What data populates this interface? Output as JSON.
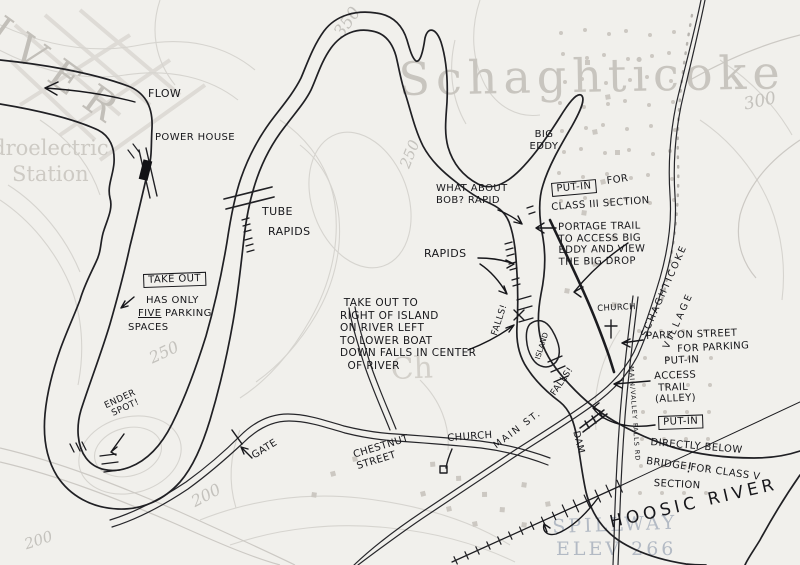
{
  "base_map": {
    "river_name": "RIVER",
    "town_name": "Schaghticoke",
    "hydro_line1": "Hydroelectric",
    "hydro_line2": "Station",
    "church_abbrev": "Ch",
    "spillway_line1": "SPILLWAY",
    "spillway_line2": "ELEV 266",
    "contour_350": "350",
    "contour_300": "300",
    "contour_250_top": "250",
    "contour_250_left": "250",
    "contour_200_bottom": "200",
    "contour_200_corner": "200"
  },
  "annotations": {
    "flow": "FLOW",
    "power_house": "POWER HOUSE",
    "take_out_box": "TAKE OUT",
    "take_out_line1": "HAS ONLY",
    "take_out_five": "FIVE",
    "take_out_parking": " PARKING",
    "take_out_line3": "SPACES",
    "tube": "TUBE",
    "tube_rapids": "RAPIDS",
    "big_eddy": "BIG\nEDDY",
    "bob_rapid": "WHAT ABOUT\nBOB? RAPID",
    "rapids": "RAPIDS",
    "putin_class3_box": "PUT-IN",
    "putin_class3_for": "FOR",
    "putin_class3_class": "CLASS III SECTION",
    "portage_note": "PORTAGE TRAIL\nTO ACCESS BIG\nEDDY AND VIEW\nTHE BIG DROP",
    "island_takeout_note": " TAKE OUT TO\nRIGHT OF ISLAND\nON RIVER LEFT\nTO LOWER BOAT\nDOWN FALLS IN CENTER\n  OF RIVER",
    "falls_upper": "FALLS!",
    "falls_lower": "FALLS!",
    "island": "ISLAND",
    "church_upper": "CHURCH",
    "church_lower": "CHURCH",
    "park_line1": "PARK ON STREET",
    "park_line2": "FOR PARKING",
    "park_line3": "PUT-IN",
    "access_trail": "ACCESS\n TRAIL\n(ALLEY)",
    "putin_class5_box": "PUT-IN",
    "putin_class5_l1": "DIRECTLY BELOW",
    "putin_class5_l2": "BRIDGE FOR CLASS V",
    "putin_class5_l3": "SECTION",
    "dam": "DAM",
    "main_valley_road": "MAIN/VALLEY FALLS RD",
    "village_line1": "SCHAGHTICOKE",
    "village_line2": "VILLAGE",
    "hoosic_river": "HOOSIC RIVER",
    "hoosic_bang": "!",
    "main_st": "MAIN ST.",
    "chestnut": "CHESTNUT\nSTREET",
    "gate": "GATE",
    "ender_spot": "ENDER\n SPOT!"
  }
}
